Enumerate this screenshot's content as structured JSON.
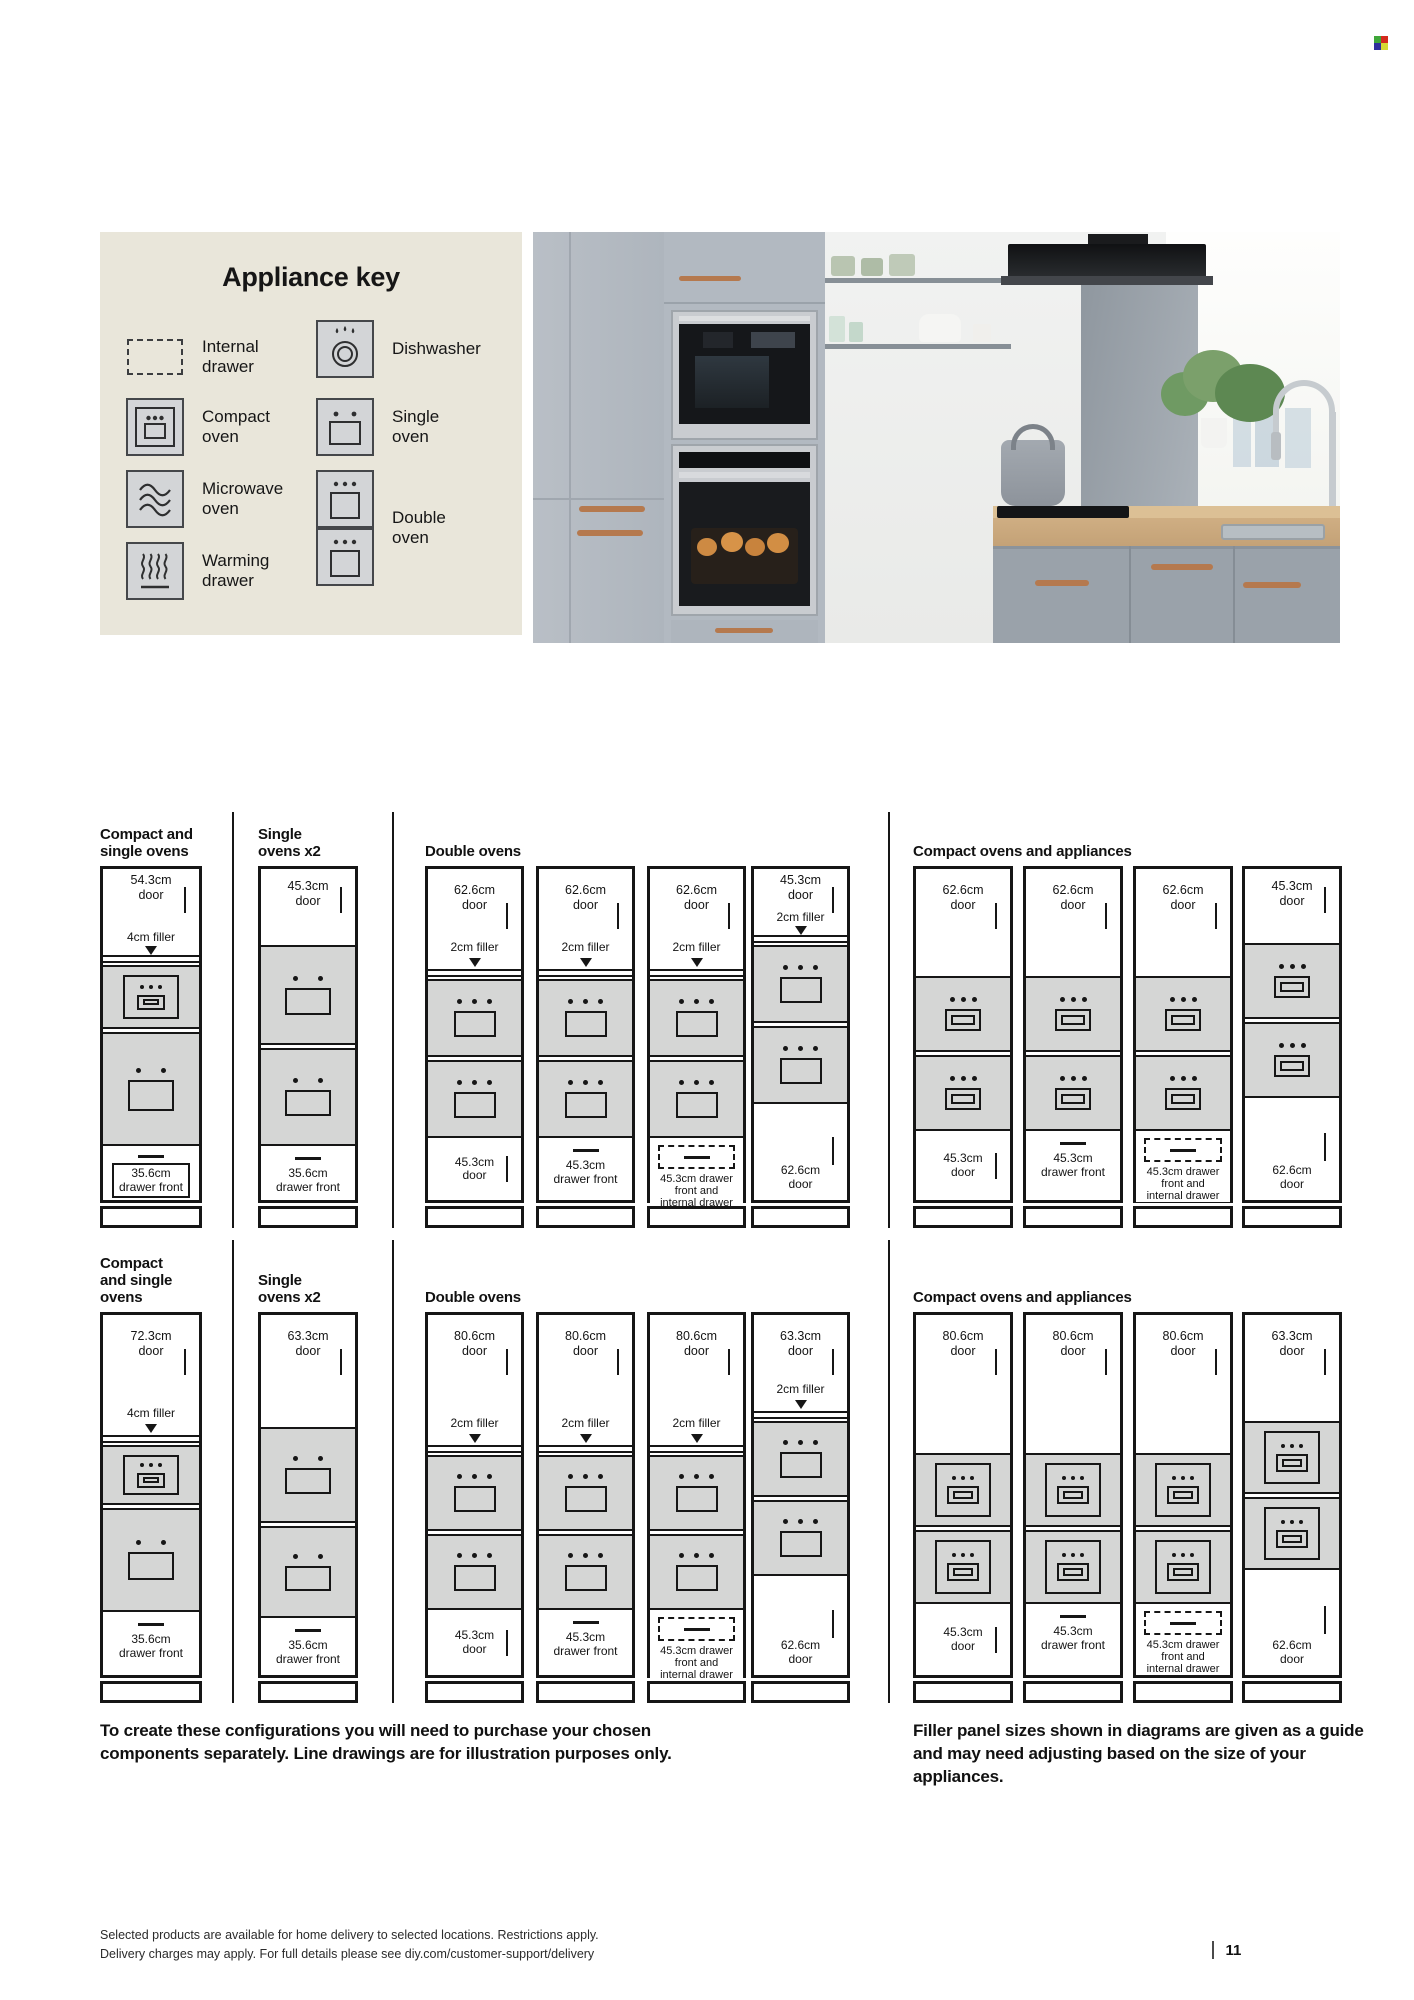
{
  "color_mark": {
    "colors": [
      "#3fa73a",
      "#d42a1d",
      "#2e2e9d",
      "#d6d932"
    ]
  },
  "appliance_key": {
    "title": "Appliance key",
    "items": [
      {
        "id": "internal-drawer",
        "label": "Internal\ndrawer"
      },
      {
        "id": "dishwasher",
        "label": "Dishwasher"
      },
      {
        "id": "compact-oven",
        "label": "Compact\noven"
      },
      {
        "id": "single-oven",
        "label": "Single\noven"
      },
      {
        "id": "microwave-oven",
        "label": "Microwave\noven"
      },
      {
        "id": "double-oven",
        "label": "Double\noven"
      },
      {
        "id": "warming-drawer",
        "label": "Warming\ndrawer"
      }
    ]
  },
  "diagram": {
    "rows": [
      {
        "groups": [
          {
            "title": "Compact and\nsingle ovens",
            "columns": [
              {
                "door": "54.3cm\ndoor",
                "filler": "4cm filler",
                "ovens": [
                  "compact",
                  "single"
                ],
                "bottom": {
                  "style": "drawer-boxed",
                  "label": "35.6cm\ndrawer front"
                }
              }
            ]
          },
          {
            "title": "Single\novens x2",
            "columns": [
              {
                "door": "45.3cm\ndoor",
                "ovens": [
                  "single",
                  "single"
                ],
                "bottom": {
                  "style": "drawer",
                  "label": "35.6cm\ndrawer front"
                }
              }
            ]
          },
          {
            "title": "Double ovens",
            "columns": [
              {
                "door": "62.6cm\ndoor",
                "filler": "2cm filler",
                "ovens": [
                  "double",
                  "double"
                ],
                "bottom": {
                  "style": "door",
                  "label": "45.3cm\ndoor"
                }
              },
              {
                "door": "62.6cm\ndoor",
                "filler": "2cm filler",
                "ovens": [
                  "double",
                  "double"
                ],
                "bottom": {
                  "style": "drawer",
                  "label": "45.3cm\ndrawer front"
                }
              },
              {
                "door": "62.6cm\ndoor",
                "filler": "2cm filler",
                "ovens": [
                  "double",
                  "double"
                ],
                "bottom": {
                  "style": "internal",
                  "label": "45.3cm drawer\nfront and\ninternal drawer"
                }
              },
              {
                "door": "45.3cm\ndoor",
                "filler": "2cm filler",
                "ovens": [
                  "double",
                  "double"
                ],
                "bottom": {
                  "style": "door-tall",
                  "label": "62.6cm\ndoor"
                }
              }
            ]
          },
          {
            "title": "Compact ovens and appliances",
            "columns": [
              {
                "door": "62.6cm\ndoor",
                "ovens": [
                  "compact-sm",
                  "compact-sm"
                ],
                "bottom": {
                  "style": "door",
                  "label": "45.3cm\ndoor"
                }
              },
              {
                "door": "62.6cm\ndoor",
                "ovens": [
                  "compact-sm",
                  "compact-sm"
                ],
                "bottom": {
                  "style": "drawer",
                  "label": "45.3cm\ndrawer front"
                }
              },
              {
                "door": "62.6cm\ndoor",
                "ovens": [
                  "compact-sm",
                  "compact-sm"
                ],
                "bottom": {
                  "style": "internal",
                  "label": "45.3cm drawer\nfront and\ninternal drawer"
                }
              },
              {
                "door": "45.3cm\ndoor",
                "ovens": [
                  "compact-sm",
                  "compact-sm"
                ],
                "bottom": {
                  "style": "door-tall",
                  "label": "62.6cm\ndoor"
                }
              }
            ]
          }
        ]
      },
      {
        "groups": [
          {
            "title": "Compact\nand single\novens",
            "columns": [
              {
                "door": "72.3cm\ndoor",
                "filler": "4cm filler",
                "ovens": [
                  "compact",
                  "single"
                ],
                "bottom": {
                  "style": "drawer",
                  "label": "35.6cm\ndrawer front"
                }
              }
            ]
          },
          {
            "title": "Single\novens x2",
            "columns": [
              {
                "door": "63.3cm\ndoor",
                "ovens": [
                  "single",
                  "single"
                ],
                "bottom": {
                  "style": "drawer",
                  "label": "35.6cm\ndrawer front"
                }
              }
            ]
          },
          {
            "title": "Double ovens",
            "columns": [
              {
                "door": "80.6cm\ndoor",
                "filler": "2cm filler",
                "ovens": [
                  "double",
                  "double"
                ],
                "bottom": {
                  "style": "door",
                  "label": "45.3cm\ndoor"
                }
              },
              {
                "door": "80.6cm\ndoor",
                "filler": "2cm filler",
                "ovens": [
                  "double",
                  "double"
                ],
                "bottom": {
                  "style": "drawer",
                  "label": "45.3cm\ndrawer front"
                }
              },
              {
                "door": "80.6cm\ndoor",
                "filler": "2cm filler",
                "ovens": [
                  "double",
                  "double"
                ],
                "bottom": {
                  "style": "internal",
                  "label": "45.3cm drawer\nfront and\ninternal drawer"
                }
              },
              {
                "door": "63.3cm\ndoor",
                "filler": "2cm filler",
                "ovens": [
                  "double",
                  "double"
                ],
                "bottom": {
                  "style": "door-tall",
                  "label": "62.6cm\ndoor"
                }
              }
            ]
          },
          {
            "title": "Compact ovens and appliances",
            "columns": [
              {
                "door": "80.6cm\ndoor",
                "ovens": [
                  "compact",
                  "compact"
                ],
                "bottom": {
                  "style": "door",
                  "label": "45.3cm\ndoor"
                }
              },
              {
                "door": "80.6cm\ndoor",
                "ovens": [
                  "compact",
                  "compact"
                ],
                "bottom": {
                  "style": "drawer",
                  "label": "45.3cm\ndrawer front"
                }
              },
              {
                "door": "80.6cm\ndoor",
                "ovens": [
                  "compact",
                  "compact"
                ],
                "bottom": {
                  "style": "internal",
                  "label": "45.3cm drawer\nfront and\ninternal drawer"
                }
              },
              {
                "door": "63.3cm\ndoor",
                "ovens": [
                  "compact",
                  "compact"
                ],
                "bottom": {
                  "style": "door-tall",
                  "label": "62.6cm\ndoor"
                }
              }
            ]
          }
        ]
      }
    ]
  },
  "notes": {
    "left": "To create these configurations you will need to purchase your chosen components separately. Line drawings are for illustration purposes only.",
    "right": "Filler panel sizes shown in diagrams are given as a guide and may need adjusting based on the size of your appliances."
  },
  "page": {
    "footnote": "Selected products are available for home delivery to selected locations. Restrictions apply.\nDelivery charges may apply. For full details please see diy.com/customer-support/delivery",
    "number": "11"
  }
}
